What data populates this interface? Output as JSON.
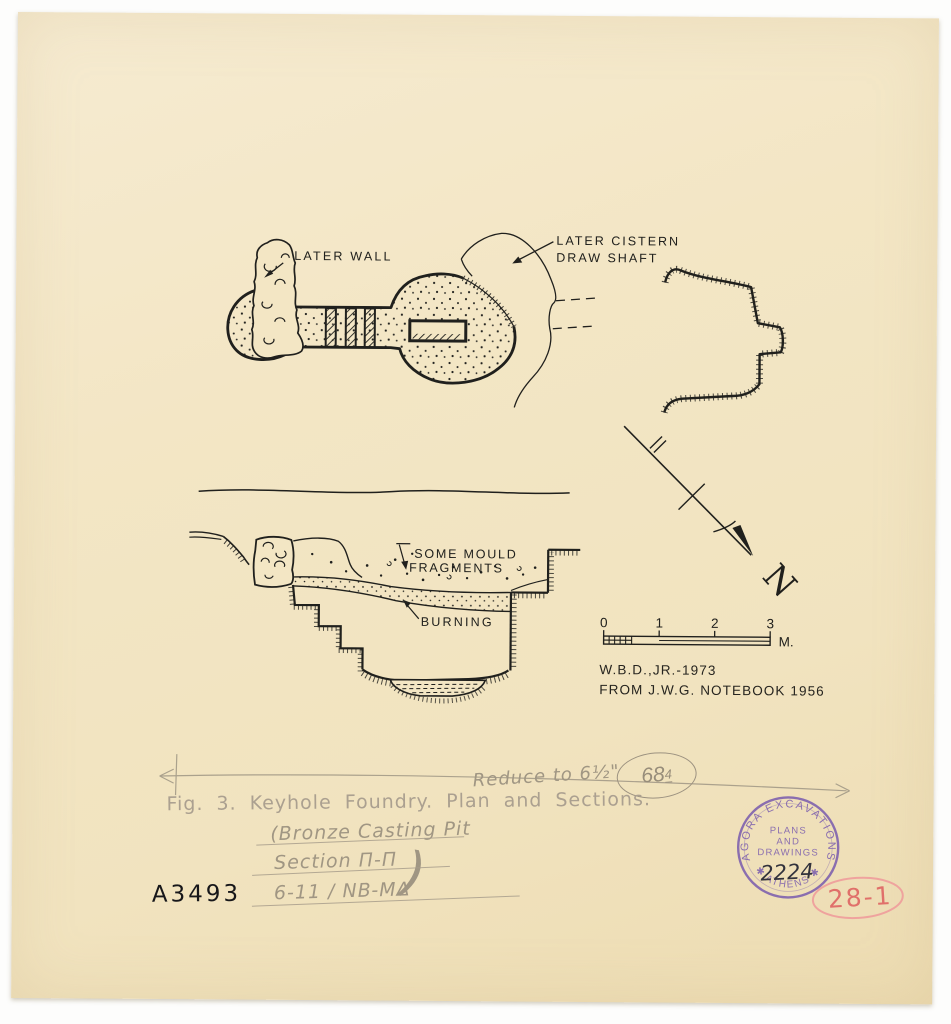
{
  "plan": {
    "labels": {
      "later_wall": "LATER WALL",
      "cistern_line1": "LATER CISTERN",
      "cistern_line2": "DRAW SHAFT"
    }
  },
  "section": {
    "labels": {
      "mould_line1": "SOME MOULD",
      "mould_line2": "FRAGMENTS",
      "burning": "BURNING"
    }
  },
  "north": {
    "label": "N"
  },
  "scalebar": {
    "ticks": [
      "0",
      "1",
      "2",
      "3"
    ],
    "unit": "M."
  },
  "credits": {
    "line1": "W.B.D.,JR.-1973",
    "line2": "FROM J.W.G. NOTEBOOK 1956"
  },
  "pencil": {
    "reduce_note": "Reduce to 6½\"",
    "circled_number": "68",
    "circled_number_sup": "4",
    "caption": "Fig. 3. Keyhole Foundry. Plan and Sections.",
    "crossed_out": [
      "(Bronze Casting Pit",
      "Section Π-Π",
      "6-11 / NB-MΔ"
    ],
    "closing_paren": ")"
  },
  "archive": {
    "inventory_number": "A3493",
    "plate_number": "28-1",
    "stamp": {
      "arc_top": "AGORA EXCAVATIONS",
      "center_line1": "PLANS",
      "center_line2": "AND",
      "center_line3": "DRAWINGS",
      "number": "2224",
      "arc_bottom": "✱ ATHENS ✱"
    }
  },
  "colors": {
    "paper": "#f2e5c3",
    "ink": "#20201d",
    "pencil": "#a59b88",
    "stamp_purple": "#7d5fae",
    "red_pencil": "#e0706a"
  }
}
